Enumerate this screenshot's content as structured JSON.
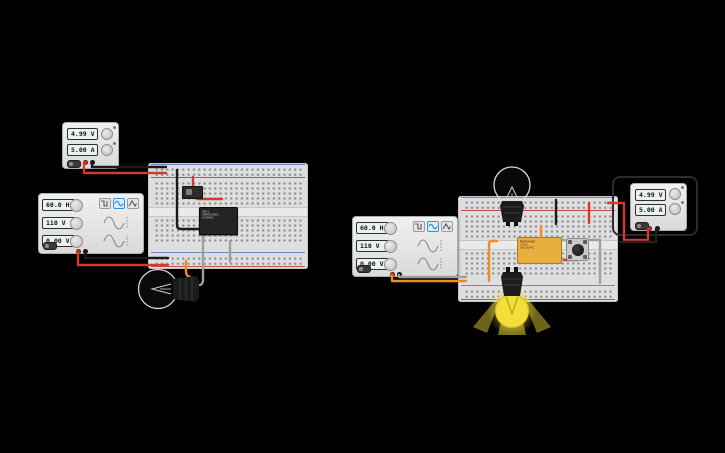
{
  "palette": {
    "background": "#000000",
    "breadboard": "#dedede",
    "wire_red": "#d13a2e",
    "wire_black": "#1a1a1a",
    "wire_gray": "#9aa0a4",
    "wire_orange": "#ee8c1e",
    "relay_body": "#e8ae3e",
    "bulb_lit": "#f2de39",
    "led_green": "#43a047",
    "waveform_selected": "#3f8fd4",
    "rail_red_line": "#c84b3f",
    "rail_blue_line": "#7187c2"
  },
  "left_circuit": {
    "power_supply": {
      "voltage": "4.99 V",
      "current": "5.00 A"
    },
    "function_generator": {
      "frequency": "60.0 Hz",
      "amplitude": "110 V",
      "offset": "0.00 V",
      "waveforms": [
        "square",
        "sine",
        "triangle"
      ],
      "selected_waveform": "sine"
    },
    "ic_chip": {
      "lines": [
        "G5V-2",
        "OMRON 5VDC",
        "2A 30VDC"
      ]
    },
    "bulb": {
      "state": "off"
    }
  },
  "right_circuit": {
    "function_generator": {
      "frequency": "60.0 Hz",
      "amplitude": "110 V",
      "offset": "0.00 V",
      "waveforms": [
        "square",
        "sine",
        "triangle"
      ],
      "selected_waveform": "sine"
    },
    "power_supply": {
      "voltage": "4.99 V",
      "current": "5.00 A",
      "selected": "true"
    },
    "relay": {
      "lines": [
        "RX34-44-003",
        "12VDC",
        "16A 250VAC"
      ]
    },
    "bulb_top": {
      "state": "off"
    },
    "bulb_bottom": {
      "state": "on"
    }
  }
}
